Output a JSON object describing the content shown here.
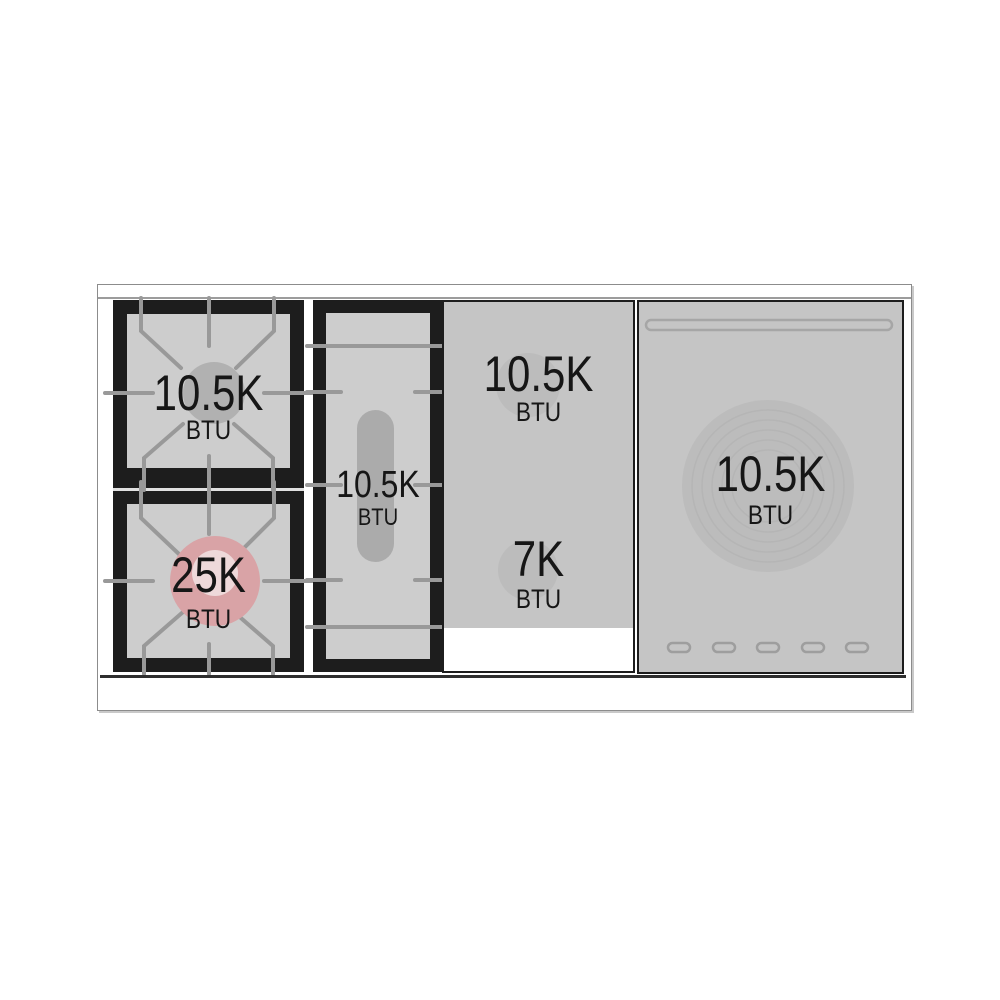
{
  "diagram": {
    "title": "range-top burner power diagram",
    "zones": {
      "burner_top_left": {
        "power": "10.5K",
        "unit": "BTU"
      },
      "burner_bottom_left": {
        "power": "25K",
        "unit": "BTU"
      },
      "griddle": {
        "power": "10.5K",
        "unit": "BTU"
      },
      "center_panel_top": {
        "power": "10.5K",
        "unit": "BTU"
      },
      "center_panel_bottom": {
        "power": "7K",
        "unit": "BTU"
      },
      "right_zone": {
        "power": "10.5K",
        "unit": "BTU"
      }
    }
  },
  "colors": {
    "frame_dark": "#1d1d1d",
    "burner_interior": "#cdcdcd",
    "grate_line": "#999999",
    "burner_cap_gray": "#b1b1b1",
    "burner_cap_pink": "#d9a3a6",
    "burner_cap_pink_inner": "#eed9da",
    "griddle_plate": "#ababab",
    "panel_gray": "#c5c5c5",
    "panel_blob": "#bcbcbc",
    "ring_line": "#b5b5b5",
    "outline_gray": "#a6a6a6",
    "text_dark": "#161616",
    "ledge_line": "#9c9c9c",
    "front_edge": "#2e2e2e",
    "unit_border": "#8c8c8c"
  }
}
